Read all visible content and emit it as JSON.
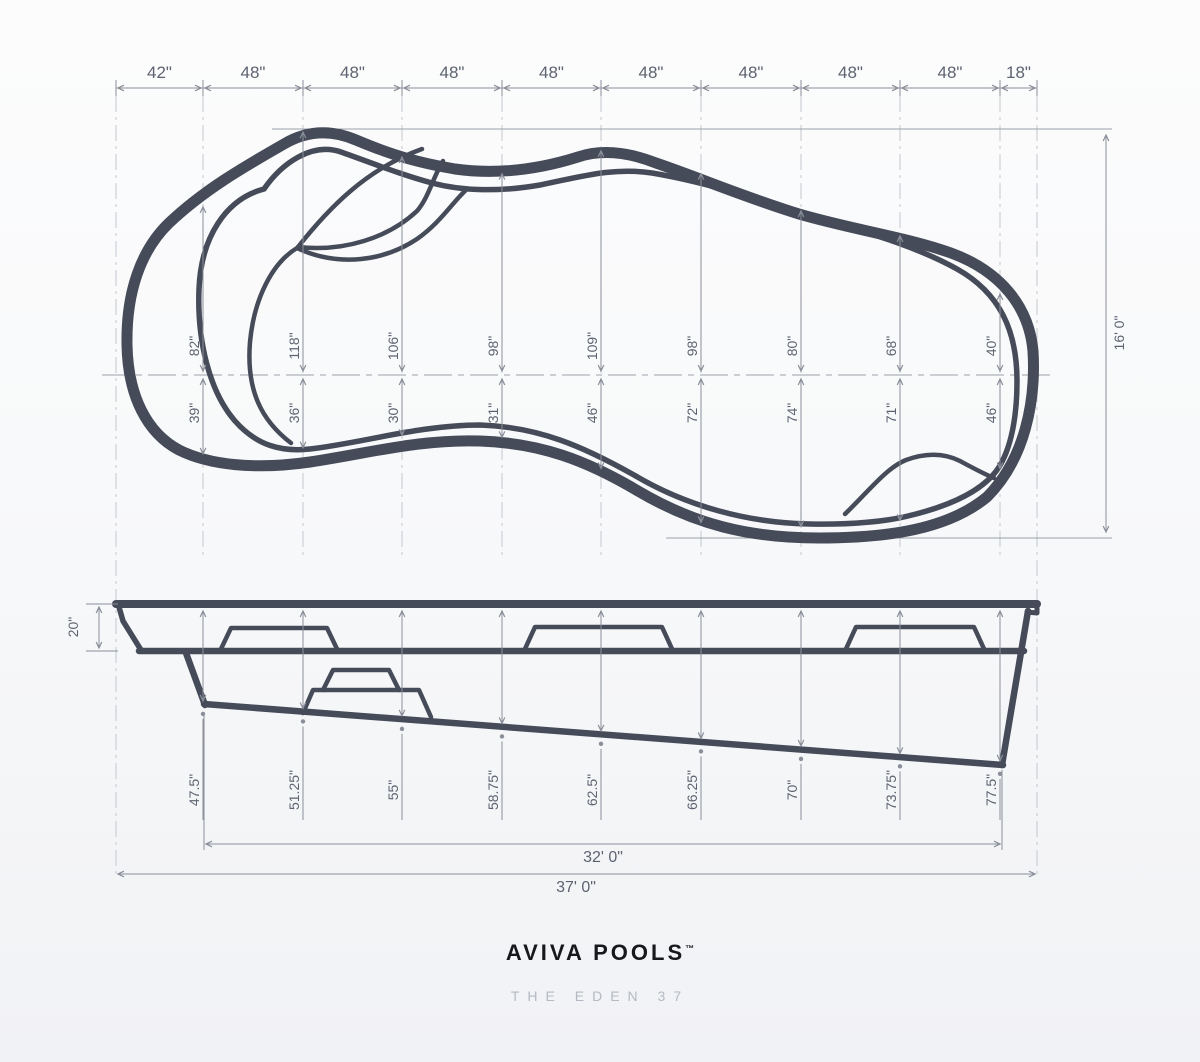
{
  "plan_view": {
    "segment_widths": [
      "42\"",
      "48\"",
      "48\"",
      "48\"",
      "48\"",
      "48\"",
      "48\"",
      "48\"",
      "48\"",
      "18\""
    ],
    "overall_width": "16' 0\"",
    "half_widths_above_centerline": [
      "82\"",
      "118\"",
      "106\"",
      "98\"",
      "109\"",
      "98\"",
      "80\"",
      "68\"",
      "40\""
    ],
    "half_widths_below_centerline": [
      "39\"",
      "36\"",
      "30\"",
      "31\"",
      "46\"",
      "72\"",
      "74\"",
      "71\"",
      "46\""
    ]
  },
  "side_view": {
    "coping_height": "20\"",
    "depths": [
      "47.5\"",
      "51.25\"",
      "55\"",
      "58.75\"",
      "62.5\"",
      "66.25\"",
      "70\"",
      "73.75\"",
      "77.5\""
    ],
    "floor_length": "32' 0\"",
    "overall_length": "37' 0\""
  },
  "footer": {
    "brand": "AVIVA POOLS",
    "trademark": "™",
    "model": "THE EDEN 37"
  },
  "colors": {
    "pool_line": "#454b59",
    "dimension_line": "#8a8f99",
    "dimension_text": "#5d6370",
    "grid_line": "#c0c4cc",
    "background_top": "#fcfcfd",
    "background_bottom": "#f1f2f5"
  }
}
